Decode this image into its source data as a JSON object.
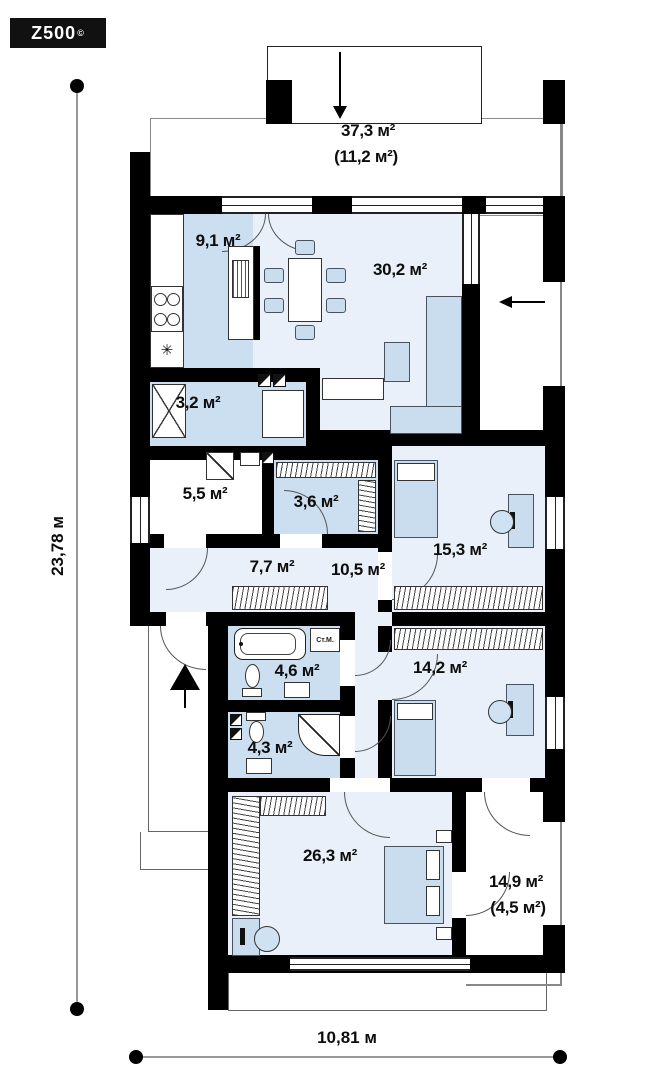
{
  "brand": {
    "logo_text": "Z500",
    "logo_mark": "©"
  },
  "dimensions": {
    "vertical": "23,78 м",
    "horizontal": "10,81 м"
  },
  "rooms": {
    "terrace_top": {
      "area": "37,3 м²",
      "area_secondary": "(11,2 м²)"
    },
    "kitchen": {
      "area": "9,1 м²"
    },
    "living_room": {
      "area": "30,2 м²"
    },
    "pantry": {
      "area": "3,2 м²"
    },
    "utility": {
      "area": "5,5 м²"
    },
    "wardrobe": {
      "area": "3,6 м²"
    },
    "hall": {
      "area": "7,7 м²"
    },
    "corridor": {
      "area": "10,5 м²"
    },
    "bedroom_1": {
      "area": "15,3 м²"
    },
    "bedroom_2": {
      "area": "14,2 м²"
    },
    "bathroom": {
      "area": "4,6 м²"
    },
    "wc": {
      "area": "4,3 м²"
    },
    "master_bedroom": {
      "area": "26,3 м²"
    },
    "terrace_bottom": {
      "area": "14,9 м²",
      "area_secondary": "(4,5 м²)"
    }
  },
  "annotations": {
    "washing_machine": "Ст.М.",
    "fridge_symbol": "✳"
  },
  "colors": {
    "wall": "#000000",
    "room_blue": "#cbdff1",
    "room_light": "#e9f0f9",
    "furniture": "#c9ddef"
  }
}
